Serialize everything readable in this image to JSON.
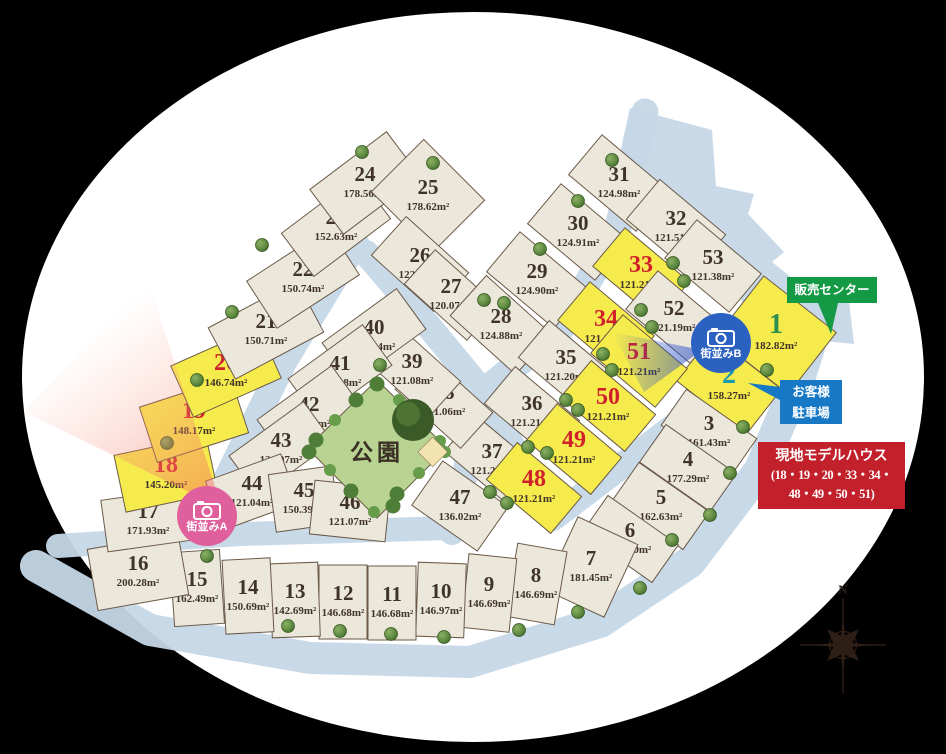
{
  "labels": {
    "sales_center": "販売センター",
    "parking_line1": "お客様",
    "parking_line2": "駐車場",
    "model_house_title": "現地モデルハウス",
    "model_house_line1": "(18・19・20・33・34・",
    "model_house_line2": "48・49・50・51)",
    "camera_a": "街並みA",
    "camera_b": "街並みB",
    "park": "公園",
    "compass_n": "N"
  },
  "colors": {
    "lot_fill": "#ece7db",
    "lot_stroke": "#6a5947",
    "highlight_fill": "#f6eb4d",
    "num_normal": "#40342a",
    "num_model": "#d0202a",
    "num_sales": "#2e8f4e",
    "num_parking": "#1c9aae",
    "road": "#c6d7e7",
    "sales_box": "#149a45",
    "parking_box": "#1778c6",
    "model_box": "#c2202b",
    "camera_a": "#e0609d",
    "camera_b": "#2b62c1"
  },
  "lots": [
    {
      "no": "1",
      "area": "182.82m²",
      "type": "sales"
    },
    {
      "no": "2",
      "area": "158.27m²",
      "type": "parking"
    },
    {
      "no": "3",
      "area": "161.43m²",
      "type": "normal"
    },
    {
      "no": "4",
      "area": "177.29m²",
      "type": "normal"
    },
    {
      "no": "5",
      "area": "162.63m²",
      "type": "normal"
    },
    {
      "no": "6",
      "area": "166.70m²",
      "type": "normal"
    },
    {
      "no": "7",
      "area": "181.45m²",
      "type": "normal"
    },
    {
      "no": "8",
      "area": "146.69m²",
      "type": "normal"
    },
    {
      "no": "9",
      "area": "146.69m²",
      "type": "normal"
    },
    {
      "no": "10",
      "area": "146.97m²",
      "type": "normal"
    },
    {
      "no": "11",
      "area": "146.68m²",
      "type": "normal"
    },
    {
      "no": "12",
      "area": "146.68m²",
      "type": "normal"
    },
    {
      "no": "13",
      "area": "142.69m²",
      "type": "normal"
    },
    {
      "no": "14",
      "area": "150.69m²",
      "type": "normal"
    },
    {
      "no": "15",
      "area": "162.49m²",
      "type": "normal"
    },
    {
      "no": "16",
      "area": "200.28m²",
      "type": "normal"
    },
    {
      "no": "17",
      "area": "171.93m²",
      "type": "normal"
    },
    {
      "no": "18",
      "area": "145.20m²",
      "type": "model"
    },
    {
      "no": "19",
      "area": "148.17m²",
      "type": "model"
    },
    {
      "no": "20",
      "area": "146.74m²",
      "type": "model"
    },
    {
      "no": "21",
      "area": "150.71m²",
      "type": "normal"
    },
    {
      "no": "22",
      "area": "150.74m²",
      "type": "normal"
    },
    {
      "no": "23",
      "area": "152.63m²",
      "type": "normal"
    },
    {
      "no": "24",
      "area": "178.56m²",
      "type": "normal"
    },
    {
      "no": "25",
      "area": "178.62m²",
      "type": "normal"
    },
    {
      "no": "26",
      "area": "122.07m²",
      "type": "normal"
    },
    {
      "no": "27",
      "area": "120.07m²",
      "type": "normal"
    },
    {
      "no": "28",
      "area": "124.88m²",
      "type": "normal"
    },
    {
      "no": "29",
      "area": "124.90m²",
      "type": "normal"
    },
    {
      "no": "30",
      "area": "124.91m²",
      "type": "normal"
    },
    {
      "no": "31",
      "area": "124.98m²",
      "type": "normal"
    },
    {
      "no": "32",
      "area": "121.51m²",
      "type": "normal"
    },
    {
      "no": "33",
      "area": "121.21m²",
      "type": "model"
    },
    {
      "no": "34",
      "area": "121.20m²",
      "type": "model"
    },
    {
      "no": "35",
      "area": "121.20m²",
      "type": "normal"
    },
    {
      "no": "36",
      "area": "121.21m²",
      "type": "normal"
    },
    {
      "no": "37",
      "area": "121.21m²",
      "type": "normal"
    },
    {
      "no": "38",
      "area": "121.06m²",
      "type": "normal"
    },
    {
      "no": "39",
      "area": "121.08m²",
      "type": "normal"
    },
    {
      "no": "40",
      "area": "121.04m²",
      "type": "normal"
    },
    {
      "no": "41",
      "area": "121.08m²",
      "type": "normal"
    },
    {
      "no": "42",
      "area": "121.08m²",
      "type": "normal"
    },
    {
      "no": "43",
      "area": "121.07m²",
      "type": "normal"
    },
    {
      "no": "44",
      "area": "121.04m²",
      "type": "normal"
    },
    {
      "no": "45",
      "area": "150.39m²",
      "type": "normal"
    },
    {
      "no": "46",
      "area": "121.07m²",
      "type": "normal"
    },
    {
      "no": "47",
      "area": "136.02m²",
      "type": "normal"
    },
    {
      "no": "48",
      "area": "121.21m²",
      "type": "model"
    },
    {
      "no": "49",
      "area": "121.21m²",
      "type": "model"
    },
    {
      "no": "50",
      "area": "121.21m²",
      "type": "model"
    },
    {
      "no": "51",
      "area": "121.21m²",
      "type": "model"
    },
    {
      "no": "52",
      "area": "121.19m²",
      "type": "normal"
    },
    {
      "no": "53",
      "area": "121.38m²",
      "type": "normal"
    }
  ]
}
